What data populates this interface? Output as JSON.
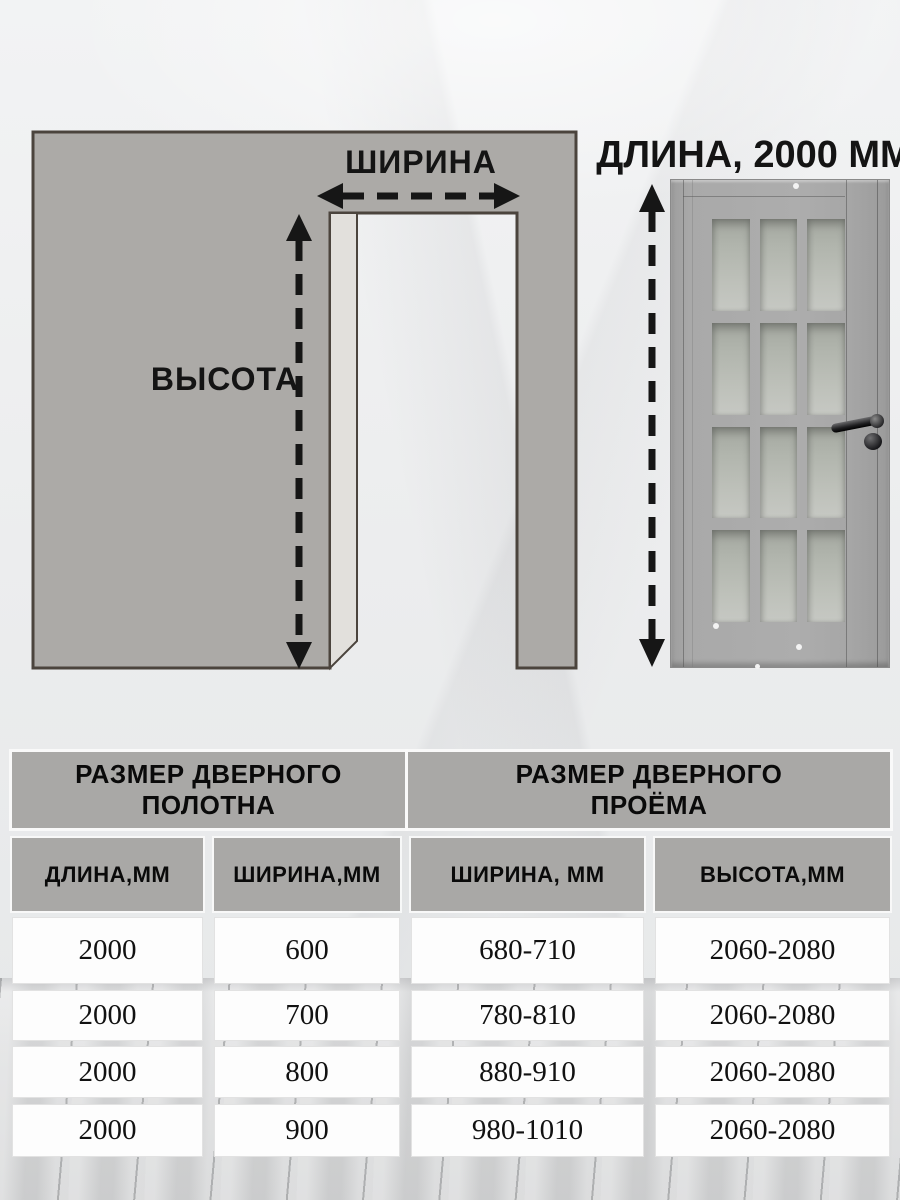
{
  "diagram": {
    "width_label": "ШИРИНА",
    "height_label": "ВЫСОТА",
    "door_length_label": "ДЛИНА, 2000 ММ"
  },
  "table": {
    "group_headers": {
      "leaf": "РАЗМЕР ДВЕРНОГО ПОЛОТНА",
      "opening": "РАЗМЕР ДВЕРНОГО ПРОЁМА"
    },
    "columns": {
      "leaf_length": "ДЛИНА,ММ",
      "leaf_width": "ШИРИНА,ММ",
      "opening_width": "ШИРИНА, ММ",
      "opening_height": "ВЫСОТА,ММ"
    },
    "rows": [
      {
        "leaf_length": "2000",
        "leaf_width": "600",
        "opening_width": "680-710",
        "opening_height": "2060-2080"
      },
      {
        "leaf_length": "2000",
        "leaf_width": "700",
        "opening_width": "780-810",
        "opening_height": "2060-2080"
      },
      {
        "leaf_length": "2000",
        "leaf_width": "800",
        "opening_width": "880-910",
        "opening_height": "2060-2080"
      },
      {
        "leaf_length": "2000",
        "leaf_width": "900",
        "opening_width": "980-1010",
        "opening_height": "2060-2080"
      }
    ]
  },
  "colors": {
    "wall_fill": "#acaaa7",
    "wall_stroke": "#4b443d",
    "arrow": "#161616",
    "header_bg": "#a9a8a6",
    "cell_bg": "#fdfdfd"
  }
}
